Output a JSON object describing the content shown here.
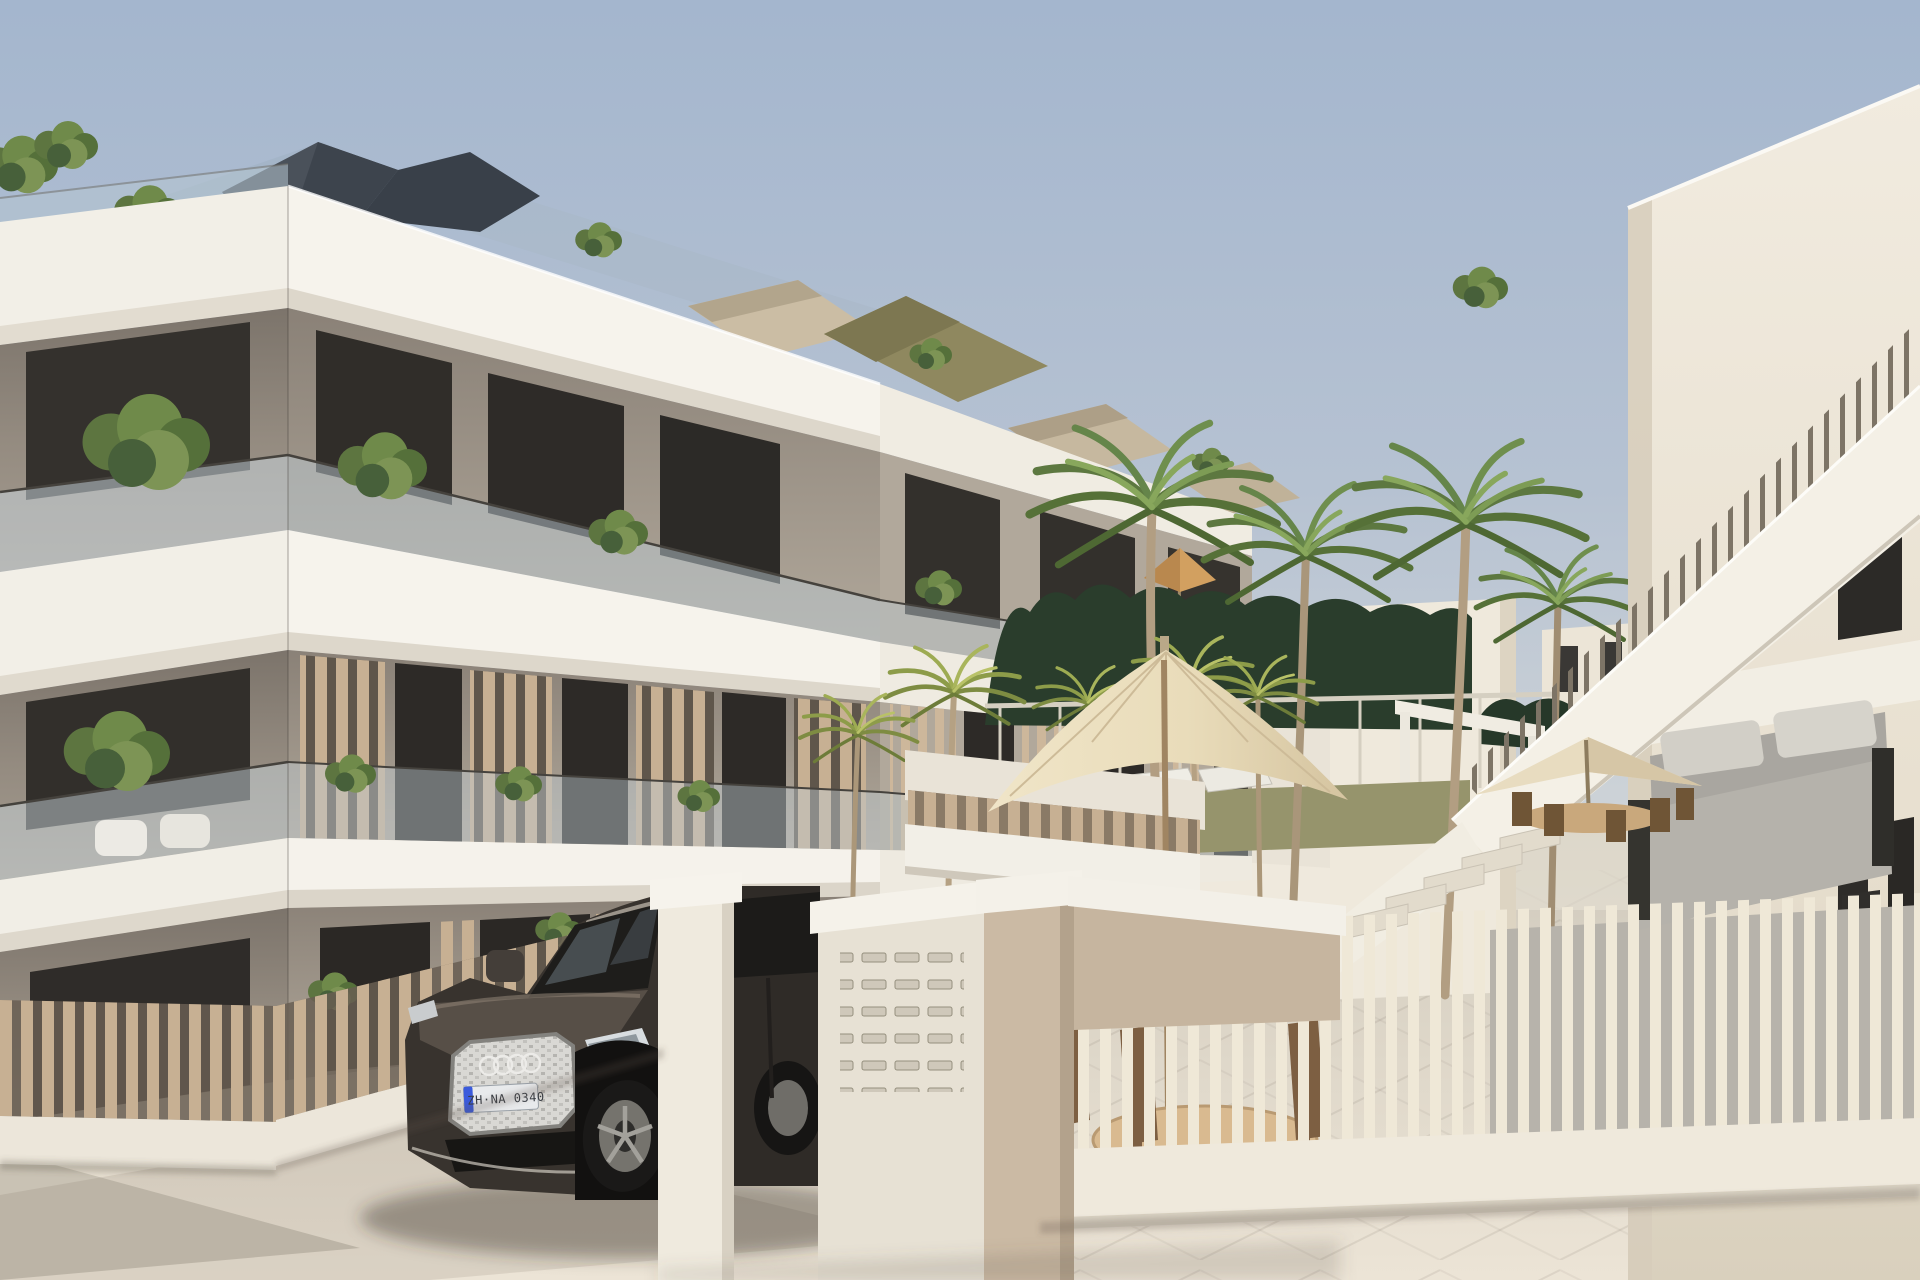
{
  "scene": {
    "type": "3D architectural rendering",
    "setting": "Modern Mediterranean apartment complex exterior on a clear day",
    "view": "street-level three-quarter view with courtyard and parked SUV"
  },
  "palette": {
    "sky_top": "#a6b7ce",
    "sky_horizon": "#e3e0d9",
    "slab_white": "#f4f1ea",
    "wall_taupe": "#9d948a",
    "wood_slat_tan": "#c7b093",
    "cream_fence": "#f0e9d9",
    "pavement": "#e6dfd2",
    "hedge_green": "#2a3d2c",
    "palm_green": "#6f8a4a",
    "car_body": "#38332e",
    "umbrella_cream": "#ecdfc4",
    "roof_dark": "#4a515a"
  },
  "building": {
    "floors": 3,
    "features": [
      "white wraparound balcony slabs",
      "glass balustrades",
      "taupe walls",
      "vertical wood-slat privacy screens",
      "rooftop terrace plants",
      "dark faceted hip roofs",
      "balcony greenery"
    ]
  },
  "vehicle": {
    "type": "SUV",
    "badge": "four-ring emblem",
    "color": "dark umber gray",
    "license_plate": "ZH·NA 0340"
  },
  "entrance": {
    "elements": [
      "white gate pillar",
      "mailbox wall with letter slots",
      "beige pillar",
      "white lintel beam"
    ],
    "mail_slot_rows": 5,
    "mail_slot_cols": 4
  },
  "courtyard": {
    "palm_trees": 10,
    "parasols": 3,
    "sun_loungers": 3,
    "hedge": "dark trimmed hedge",
    "furniture": [
      "wooden dining set",
      "gray outdoor sofa",
      "wooden chairs"
    ],
    "fence": "cream and tan vertical slat fences"
  },
  "right_wing": {
    "features": [
      "white facade",
      "dark framed windows",
      "external staircase with white parapet",
      "slat balustrade",
      "pergola"
    ]
  }
}
